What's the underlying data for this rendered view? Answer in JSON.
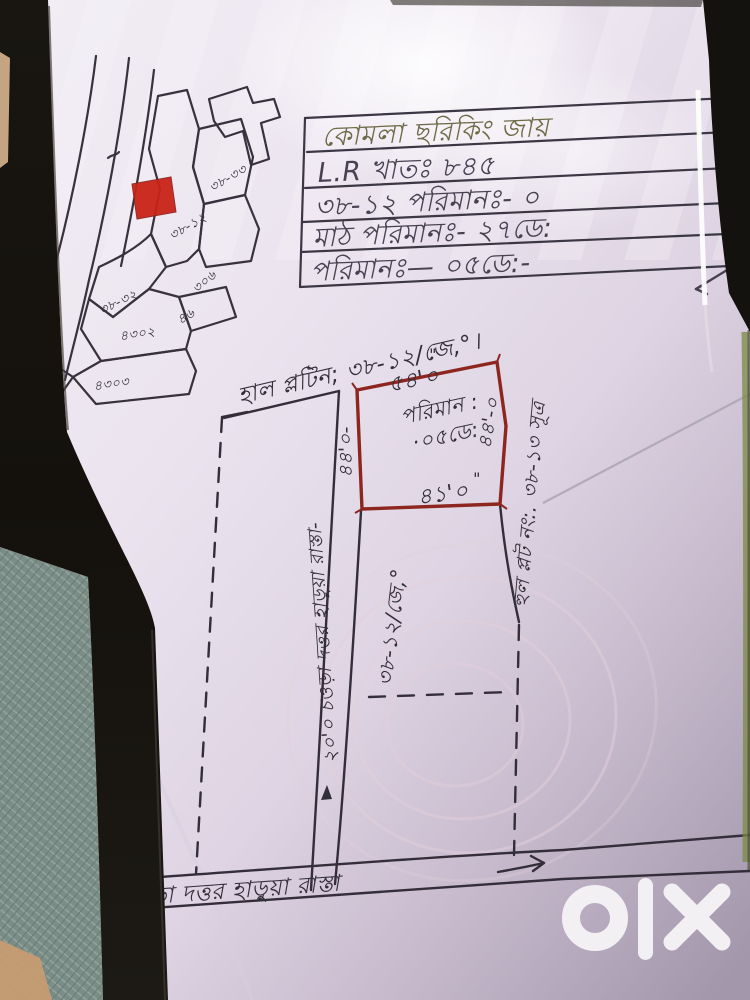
{
  "info_table": {
    "rows": [
      "কোমলা ছরিকিং জায়",
      "L.R খাতঃ ৮৪৫",
      "৩৮-১২   পরিমানঃ- ০",
      "মাঠ পরিমানঃ- ২৭ডে:",
      "পরিমানঃ— ০৫ডে:-"
    ]
  },
  "survey_title": "হাল প্লটিন; ৩৮-১২/জে,°।",
  "main_plot": {
    "top": "৫৪'০",
    "bottom": "৪১'০",
    "left": "৪৪'০-",
    "right": "৪৪'-০",
    "area_line1": "পরিমান :",
    "area_line2": "·০৫ডে:",
    "ditto_mark": "\"",
    "outline_color": "#8e2620"
  },
  "lower_plot_label": "৩৮-১২/জে,°",
  "right_margin_note": "হুল প্লট নং:. ৩৮-১৩ সূত্র",
  "middle_road_label": "২০'০ চওড়া দত্তর হাড়ুয়া রাস্তা-",
  "bottom_road": {
    "label": "২'০\" চওড়া দত্তর হাড়ুয়া রাস্তা",
    "arrow": "→"
  },
  "mini_map": {
    "highlight_color": "#c92317",
    "plot_numbers": [
      "৩৮-৩৩",
      "৩৮-১২",
      "৩৮-৩২",
      "৩০৬",
      "৪৬",
      "৪৩০২",
      "৪৩০৩",
      "৩৮"
    ]
  },
  "watermark": {
    "brand": "olx",
    "color": "#f3f0f3"
  }
}
